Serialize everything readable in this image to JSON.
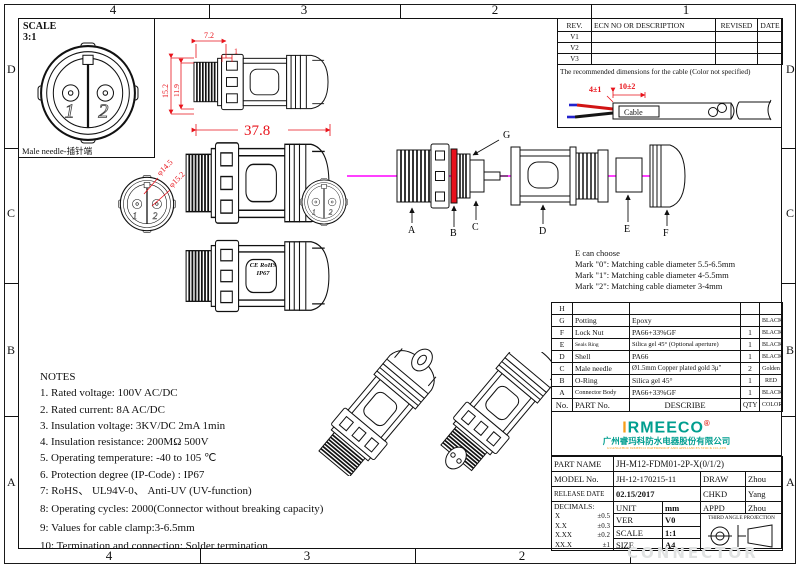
{
  "border": {
    "cols_top": [
      "4",
      "3",
      "2",
      "1"
    ],
    "cols_bottom": [
      "4",
      "3",
      "2"
    ],
    "rows": [
      "D",
      "C",
      "B",
      "A"
    ]
  },
  "scale_box": {
    "label": "SCALE",
    "value": "3:1",
    "caption": "Male needle-插针端",
    "pins": {
      "p1": "1",
      "p2": "2"
    }
  },
  "dims": {
    "w_top": "7.2",
    "w_top2": "1",
    "h_outer": "15.2",
    "h_inner": "11.9",
    "length": "37.8",
    "phi_inner": "φ14.5",
    "phi_outer": "φ15.2"
  },
  "markings": {
    "ce": "CE RoHS",
    "ip": "IP67"
  },
  "revision_table": {
    "headers": [
      "REV.",
      "ECN NO OR DESCRIPTION",
      "REVISED",
      "DATE"
    ],
    "rows": [
      "V1",
      "V2",
      "V3"
    ]
  },
  "cable_box": {
    "note": "The recommended dimensions for the cable (Color not specified)",
    "dim_a": "4±1",
    "dim_b": "10±2",
    "cable_label": "Cable"
  },
  "exploded": {
    "a": "A",
    "b": "B",
    "c": "C",
    "d": "D",
    "e": "E",
    "f": "F",
    "g": "G"
  },
  "e_options": {
    "title": "E can choose",
    "lines": [
      "Mark \"0\": Matching cable diameter 5.5-6.5mm",
      "Mark \"1\": Matching cable diameter 4-5.5mm",
      "Mark \"2\": Matching cable diameter 3-4mm"
    ]
  },
  "notes": {
    "title": "NOTES",
    "lines": [
      "1. Rated voltage: 100V AC/DC",
      "2. Rated current: 8A AC/DC",
      "3. Insulation voltage: 3KV/DC 2mA 1min",
      "4. Insulation resistance: 200MΩ 500V",
      "5. Operating temperature: -40 to 105 ℃",
      "6. Protection degree (IP-Code) : IP67",
      "7: RoHS、 UL94V-0、 Anti-UV (UV-function)",
      "8: Operating cycles: 2000(Connector without breaking capacity)",
      "9: Values for cable clamp:3-6.5mm",
      "10: Termination and connection: Solder termination"
    ]
  },
  "parts_table": {
    "headers": {
      "no": "No.",
      "part": "PART No.",
      "describe": "DESCRIBE",
      "qty": "QTY",
      "color": "COLOR"
    },
    "rows": [
      {
        "no": "H",
        "part": "",
        "describe": "",
        "qty": "",
        "color": ""
      },
      {
        "no": "G",
        "part": "Potting",
        "describe": "Epoxy",
        "qty": "",
        "color": "BLACK"
      },
      {
        "no": "F",
        "part": "Lock Nut",
        "describe": "PA66+33%GF",
        "qty": "1",
        "color": "BLACK"
      },
      {
        "no": "E",
        "part": "Seals Ring",
        "describe": "Silica gel 45°  (Optional aperture)",
        "qty": "1",
        "color": "BLACK"
      },
      {
        "no": "D",
        "part": "Shell",
        "describe": "PA66",
        "qty": "1",
        "color": "BLACK"
      },
      {
        "no": "C",
        "part": "Male needle",
        "describe": "Ø1.5mm Copper plated gold 3μ\"",
        "qty": "2",
        "color": "Golden"
      },
      {
        "no": "B",
        "part": "O-Ring",
        "describe": "Silica gel 45°",
        "qty": "1",
        "color": "RED"
      },
      {
        "no": "A",
        "part": "Connector Body",
        "describe": "PA66+33%GF",
        "qty": "1",
        "color": "BLACK"
      }
    ]
  },
  "brand": {
    "logo_i": "I",
    "logo_rest": "RMEECO",
    "reg": "®",
    "company_cn": "广州睿玛科防水电器股份有限公司",
    "company_en": "GUANGZHOU IRMEECO WATERPROOF AND APPLIANCES STOCK CO.,LTD"
  },
  "title_block": {
    "part_name_label": "PART NAME",
    "part_name": "JH-M12-FDM01-2P-X(0/1/2)",
    "model_label": "MODEL No.",
    "model": "JH-12-170215-11",
    "draw_label": "DRAW",
    "draw": "Zhou",
    "release_label": "RELEASE DATE",
    "release": "02.15/2017",
    "chkd_label": "CHKD",
    "chkd": "Yang",
    "decimals_label": "DECIMALS:",
    "decimals": [
      {
        "k": "X",
        "v": "±0.5"
      },
      {
        "k": "X.X",
        "v": "±0.3"
      },
      {
        "k": "X.XX",
        "v": "±0.2"
      },
      {
        "k": "XX.X",
        "v": "±1"
      }
    ],
    "unit_label": "UNIT",
    "unit": "mm",
    "appd_label": "APPD",
    "appd": "Zhou",
    "ver_label": "VER",
    "ver": "V0",
    "projection": "THIRD ANGLE PROJECTION",
    "scale_label": "SCALE",
    "scale": "1:1",
    "size_label": "SIZE",
    "size": "A4"
  },
  "watermark": "CONNECTOR",
  "colors": {
    "accent_red": "#e8131b",
    "centerline_magenta": "#ff00ff",
    "brand_teal": "#009e8f",
    "brand_orange": "#f59e1b",
    "oring_red": "#e8101c"
  }
}
